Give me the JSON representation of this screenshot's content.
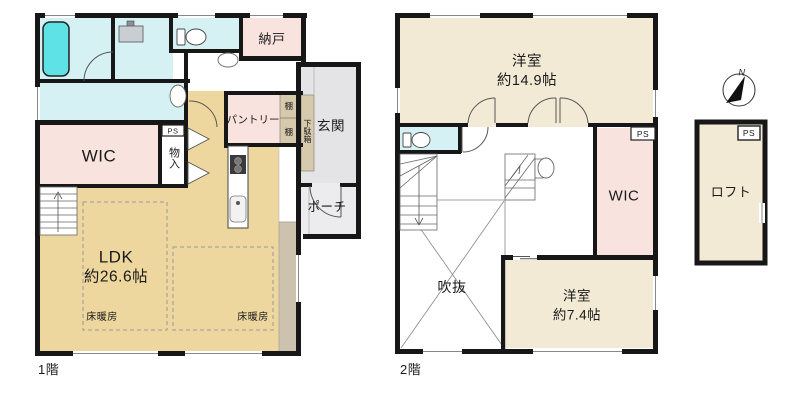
{
  "floor1": {
    "name": "1階",
    "ldk": {
      "label": "LDK",
      "size": "約26.6帖"
    },
    "floor_heating_1": "床暖房",
    "floor_heating_2": "床暖房",
    "wic": "WIC",
    "closet": "物入",
    "storeroom": "納戸",
    "pantry": "パントリー",
    "shelf_1": "棚",
    "shelf_2": "棚",
    "shoe_cabinet": "下駄箱",
    "entrance": "玄関",
    "porch": "ポーチ",
    "ps": "PS"
  },
  "floor2": {
    "name": "2階",
    "bedroom_large": {
      "label": "洋室",
      "size": "約14.9帖"
    },
    "bedroom_small": {
      "label": "洋室",
      "size": "約7.4帖"
    },
    "wic": "WIC",
    "void": "吹抜",
    "ps": "PS"
  },
  "loft": {
    "label": "ロフト",
    "ps": "PS"
  },
  "compass": {
    "north": "N"
  },
  "colors": {
    "room_cream": "#f3ead6",
    "room_tan": "#eed79e",
    "room_pink": "#f9e3de",
    "room_cyan": "#d6f1f3",
    "bathtub": "#5fe2e6",
    "entrance_gray": "#e4e4e7",
    "porch_gray": "#ececee",
    "cabinet_tan": "#d7c9ab",
    "deck_strip": "#cdc2ae",
    "wall": "#171717"
  }
}
